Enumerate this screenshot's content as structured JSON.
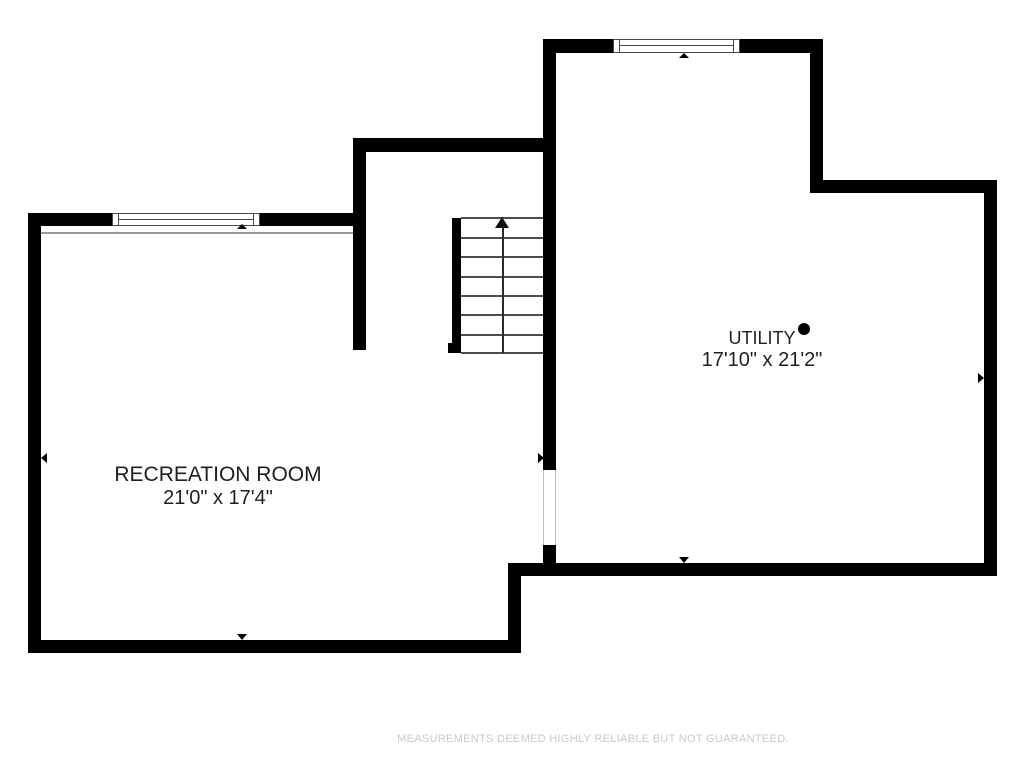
{
  "floor_plan": {
    "rooms": [
      {
        "name": "RECREATION ROOM",
        "dimensions": "21'0\" x 17'4\""
      },
      {
        "name": "UTILITY",
        "dimensions": "17'10\" x 21'2\""
      }
    ],
    "stairs": {
      "direction": "up",
      "treads": 7
    },
    "windows": 2,
    "disclaimer": "MEASUREMENTS DEEMED HIGHLY RELIABLE BUT NOT GUARANTEED.",
    "colors": {
      "wall": "#000000",
      "room_label": "#1f1f1f",
      "stair_line": "#4d4d4d",
      "disclaimer": "#c9c9c9"
    }
  }
}
